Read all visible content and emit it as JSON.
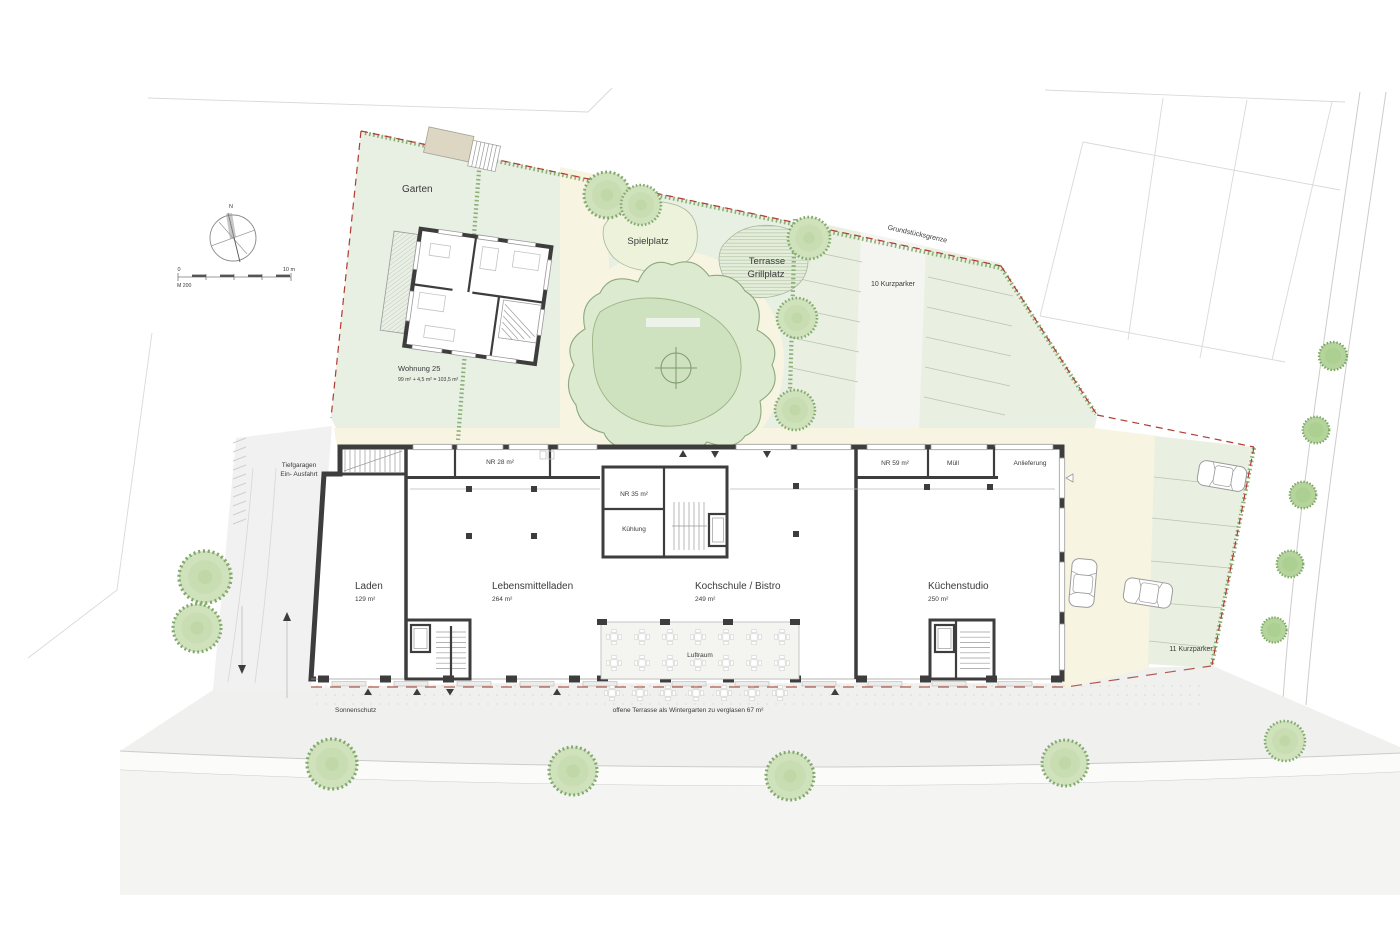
{
  "plan": {
    "areas": {
      "garten": "Garten",
      "spielplatz": "Spielplatz",
      "terrasse_line1": "Terrasse",
      "terrasse_line2": "Grillplatz",
      "grundstuecksgrenze": "Grundstücksgrenze",
      "parking_top": "10 Kurzparker",
      "parking_right": "11 Kurzparker",
      "luftraum": "Luftraum"
    },
    "wohnung": {
      "name": "Wohnung 25",
      "area": "99 m² + 4,5 m² = 103,5 m²"
    },
    "rooms": {
      "laden": {
        "name": "Laden",
        "area": "129 m²"
      },
      "lebensmittelladen": {
        "name": "Lebensmittelladen",
        "area": "264 m²"
      },
      "kochschule": {
        "name": "Kochschule / Bistro",
        "area": "249 m²"
      },
      "kuechenstudio": {
        "name": "Küchenstudio",
        "area": "250 m²"
      },
      "nr28": "NR 28 m²",
      "nr35": "NR 35 m²",
      "nr59": "NR 59 m²",
      "muell": "Müll",
      "anlieferung": "Anlieferung",
      "kuehlung": "Kühlung"
    },
    "annotations": {
      "tiefgarage_line1": "Tiefgaragen",
      "tiefgarage_line2": "Ein- Ausfahrt",
      "sonnenschutz": "Sonnenschutz",
      "wintergarten": "offene Terrasse als Wintergarten zu verglasen 67 m²"
    },
    "legend": {
      "north": "N",
      "scale_start": "0",
      "scale_end": "10 m",
      "scale_label": "M 200"
    },
    "colors": {
      "site_green": "#e8efe3",
      "path_cream": "#f7f4e1",
      "parking_green": "#eaf0e1",
      "canopy": "#dcead0",
      "lawn": "#cfe2bf",
      "hedge": "#7fa86c",
      "boundary": "#b23a31",
      "wall": "#3d3d3d",
      "terrace_line": "#ad5a4e",
      "tree_fill": "#cfe2bc",
      "tree_stroke": "#82a96d"
    }
  }
}
